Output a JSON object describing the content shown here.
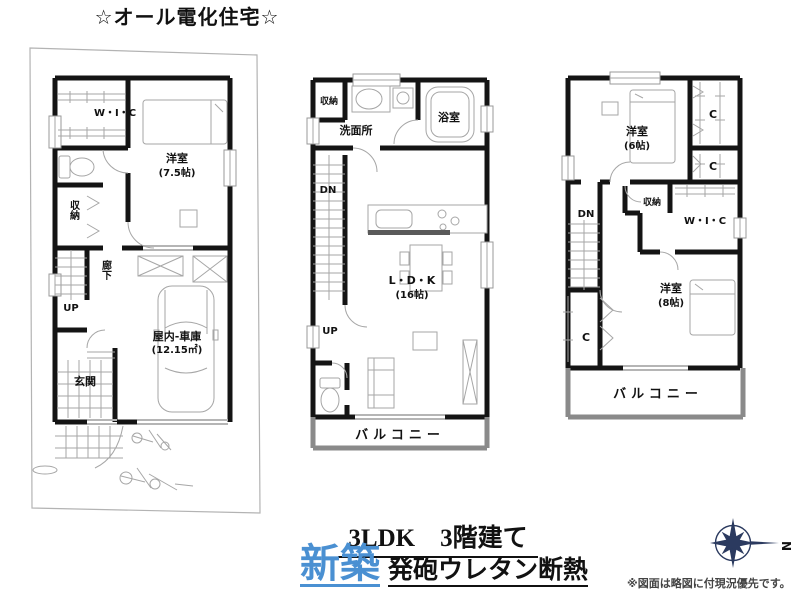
{
  "title": "☆オール電化住宅☆",
  "floor1": {
    "wic": "W・I・C",
    "room_name": "洋室",
    "room_size": "(7.5帖)",
    "closet": "収納",
    "hall": "廊下",
    "up": "UP",
    "garage_name": "屋内-車庫",
    "garage_size": "(12.15㎡)",
    "entrance": "玄関"
  },
  "floor2": {
    "closet": "収納",
    "washroom": "洗面所",
    "bath": "浴室",
    "dn": "DN",
    "ldk_name": "L・D・K",
    "ldk_size": "(16帖)",
    "up": "UP",
    "balcony": "バルコニー"
  },
  "floor3": {
    "room1_name": "洋室",
    "room1_size": "(6帖)",
    "closet_c1": "C",
    "closet_c2": "C",
    "closet": "収納",
    "wic": "W・I・C",
    "dn": "DN",
    "room2_name": "洋室",
    "room2_size": "(8帖)",
    "closet_c3": "C",
    "balcony": "バルコニー"
  },
  "footer": {
    "plan_type": "3LDK　3階建て",
    "new_build": "新築",
    "insulation": "発砲ウレタン断熱",
    "note": "※図面は略図に付現況優先です。",
    "compass_north": "N"
  },
  "colors": {
    "wall": "#141414",
    "accent_blue": "#4a90d2",
    "compass_navy": "#2b3a5f",
    "balcony_gray": "#8a8a8a"
  }
}
